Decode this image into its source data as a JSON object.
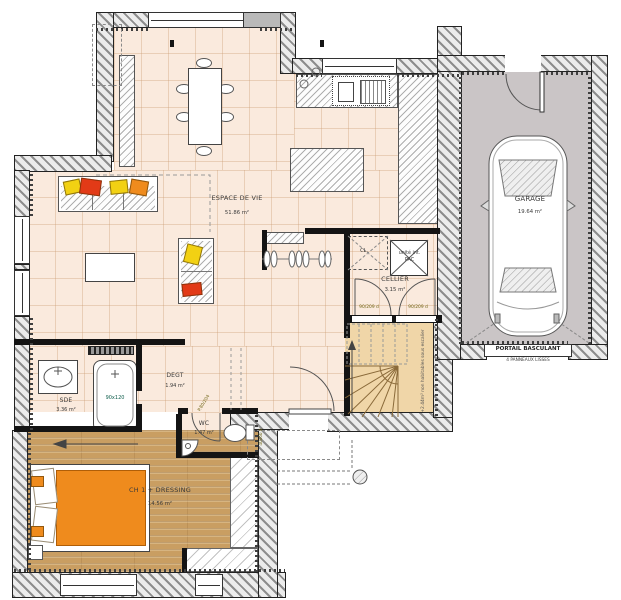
{
  "rooms": {
    "espace_de_vie": {
      "name": "ESPACE DE VIE",
      "area": "51.86 m²"
    },
    "garage": {
      "name": "GARAGE",
      "area": "19.64 m²"
    },
    "cellier": {
      "name": "CELLIER",
      "area": "3.15 m²"
    },
    "sde": {
      "name": "SDE",
      "area": "3.36 m²"
    },
    "degt": {
      "name": "DEGT",
      "area": "1.94 m²"
    },
    "wc": {
      "name": "WC",
      "area": "1.47 m²"
    },
    "chambre1": {
      "name": "CH 1 + DRESSING",
      "area": "14.56 m²"
    }
  },
  "labels": {
    "portail": "PORTAIL BASCULANT",
    "portail_sub": "4 PANNEAUX LISSES",
    "pac_line1": "unité int.",
    "pac_line2": "PAC",
    "closet": "CL.",
    "shower_size": "90x120",
    "stairs_note": "+2.44m² non habitables sous escalier",
    "door_cellier_left": "90/209 d",
    "door_cellier_right": "90/209 d",
    "door_wc": "P.80/204",
    "wc_window": "40x60 d"
  },
  "colors": {
    "tile_floor": "#faeadd",
    "wood_floor": "#c99e62",
    "garage_floor": "#cac5c6",
    "stair_floor": "#f0d6a8",
    "accent_orange": "#ef8b1d",
    "accent_yellow": "#f2d113",
    "accent_red": "#e23a17"
  }
}
